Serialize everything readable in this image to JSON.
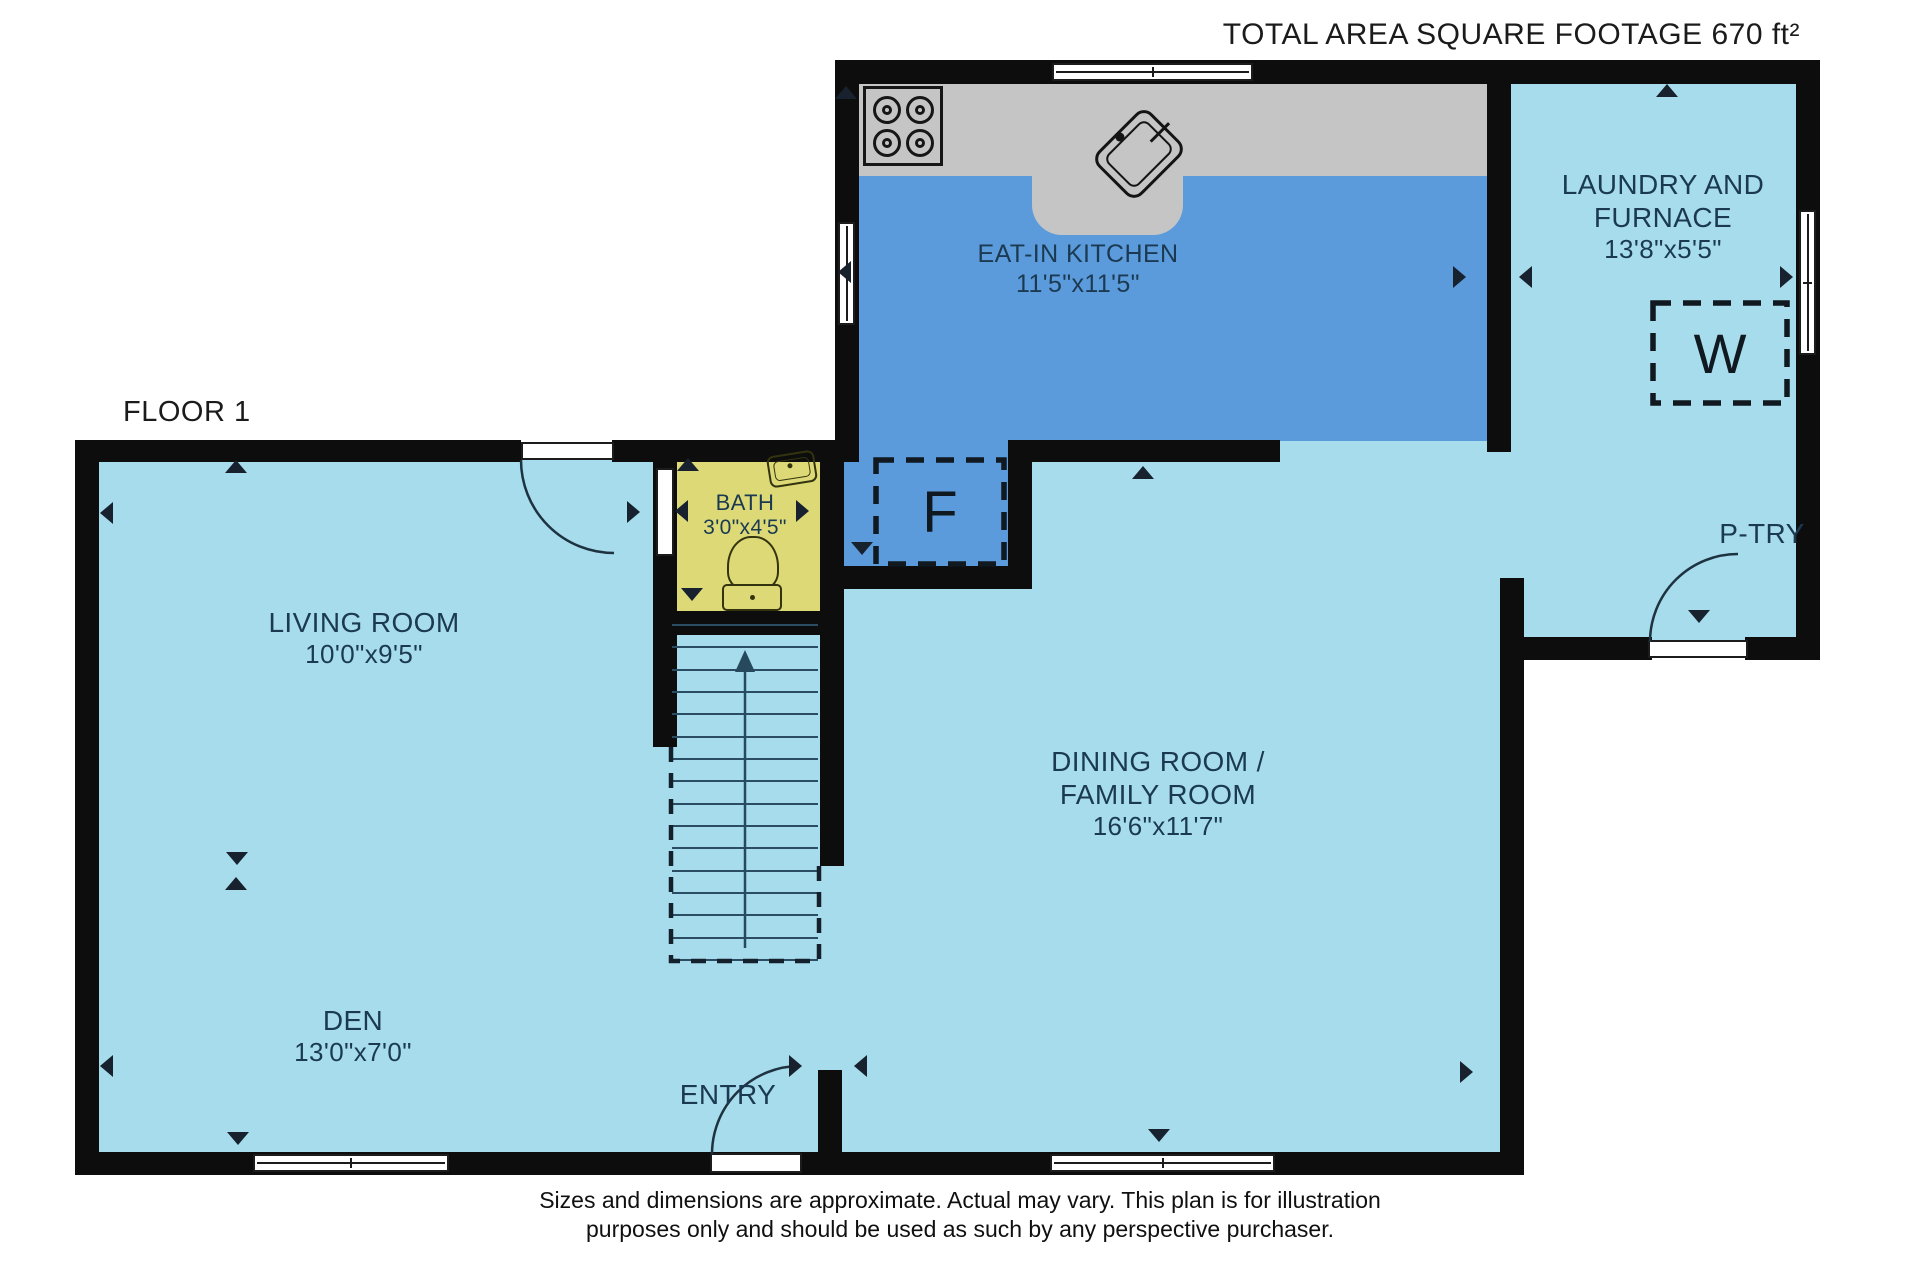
{
  "header": {
    "title": "TOTAL AREA SQUARE FOOTAGE 670  ft²"
  },
  "floor": {
    "label": "FLOOR 1"
  },
  "rooms": {
    "kitchen": {
      "name": "EAT-IN KITCHEN",
      "dims": "11'5\"x11'5\""
    },
    "laundry": {
      "line1": "LAUNDRY AND",
      "line2": "FURNACE",
      "dims": "13'8\"x5'5\""
    },
    "bath": {
      "name": "BATH",
      "dims": "3'0\"x4'5\""
    },
    "living": {
      "name": "LIVING ROOM",
      "dims": "10'0\"x9'5\""
    },
    "dining": {
      "line1": "DINING ROOM /",
      "line2": "FAMILY ROOM",
      "dims": "16'6\"x11'7\""
    },
    "den": {
      "name": "DEN",
      "dims": "13'0\"x7'0\""
    },
    "pantry": {
      "name": "P-TRY"
    },
    "entry": {
      "name": "ENTRY"
    }
  },
  "appliances": {
    "washer": "W",
    "furnace": "F"
  },
  "footer": {
    "line1": "Sizes and dimensions are approximate. Actual may vary. This plan is for illustration",
    "line2": "purposes only and should be used as such by any perspective purchaser."
  },
  "colors": {
    "wall": "#0d0d0d",
    "room_light_blue": "#a6dcec",
    "kitchen_blue": "#5b9bdb",
    "counter_gray": "#c5c5c5",
    "bath_yellow": "#dcd976",
    "label_text": "#1b3a52"
  }
}
